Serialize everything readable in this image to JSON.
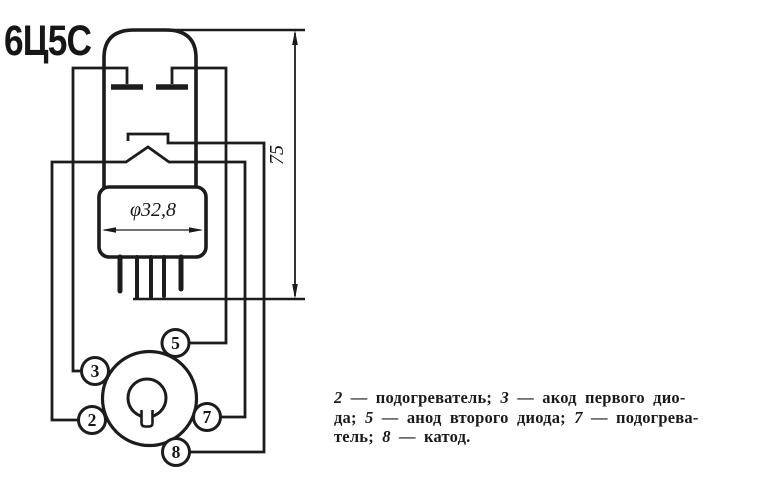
{
  "colors": {
    "ink": "#1c1c1c",
    "paper": "#ffffff"
  },
  "title": "6Ц5С",
  "drawing": {
    "diameter_label": "φ32,8",
    "height_label": "75"
  },
  "socket": {
    "pins": [
      {
        "number": "5"
      },
      {
        "number": "3"
      },
      {
        "number": "2"
      },
      {
        "number": "7"
      },
      {
        "number": "8"
      }
    ]
  },
  "caption": {
    "lines": [
      {
        "segments": [
          {
            "t": "2",
            "i": true
          },
          {
            "t": " — подогреватель; ",
            "i": false
          },
          {
            "t": "3",
            "i": true
          },
          {
            "t": " — акод первого дио-",
            "i": false
          }
        ]
      },
      {
        "segments": [
          {
            "t": "да; ",
            "i": false
          },
          {
            "t": "5",
            "i": true
          },
          {
            "t": " — анод второго диода; ",
            "i": false
          },
          {
            "t": "7",
            "i": true
          },
          {
            "t": " — подогрева-",
            "i": false
          }
        ]
      },
      {
        "segments": [
          {
            "t": "тель; ",
            "i": false
          },
          {
            "t": "8",
            "i": true
          },
          {
            "t": " — катод.",
            "i": false
          }
        ]
      }
    ]
  }
}
